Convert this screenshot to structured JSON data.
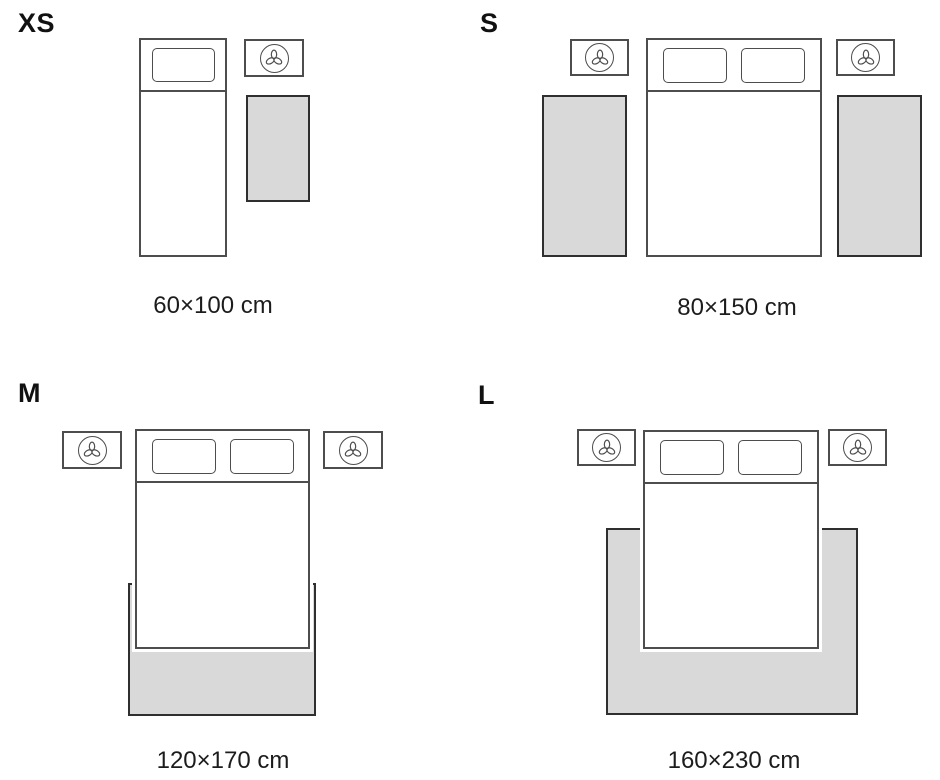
{
  "title": "Rug size guide diagram",
  "colors": {
    "background": "#ffffff",
    "furniture_outline": "#4d4d4d",
    "rug_fill": "#d9d9d9",
    "rug_border": "#2f2f2f",
    "text": "#111111"
  },
  "icons": {
    "nightstand": "plant-icon"
  },
  "sections": [
    {
      "id": "xs",
      "label": "XS",
      "caption": "60×100 cm",
      "bed_type": "single",
      "rug_placement": "beside bed",
      "rug_count": 1,
      "nightstand_count": 1
    },
    {
      "id": "s",
      "label": "S",
      "caption": "80×150 cm",
      "bed_type": "double",
      "rug_placement": "runner on each side of bed",
      "rug_count": 2,
      "nightstand_count": 2
    },
    {
      "id": "m",
      "label": "M",
      "caption": "120×170 cm",
      "bed_type": "double",
      "rug_placement": "under lower part of bed",
      "rug_count": 1,
      "nightstand_count": 2
    },
    {
      "id": "l",
      "label": "L",
      "caption": "160×230 cm",
      "bed_type": "double",
      "rug_placement": "under bed, extending on three sides",
      "rug_count": 1,
      "nightstand_count": 2
    }
  ]
}
